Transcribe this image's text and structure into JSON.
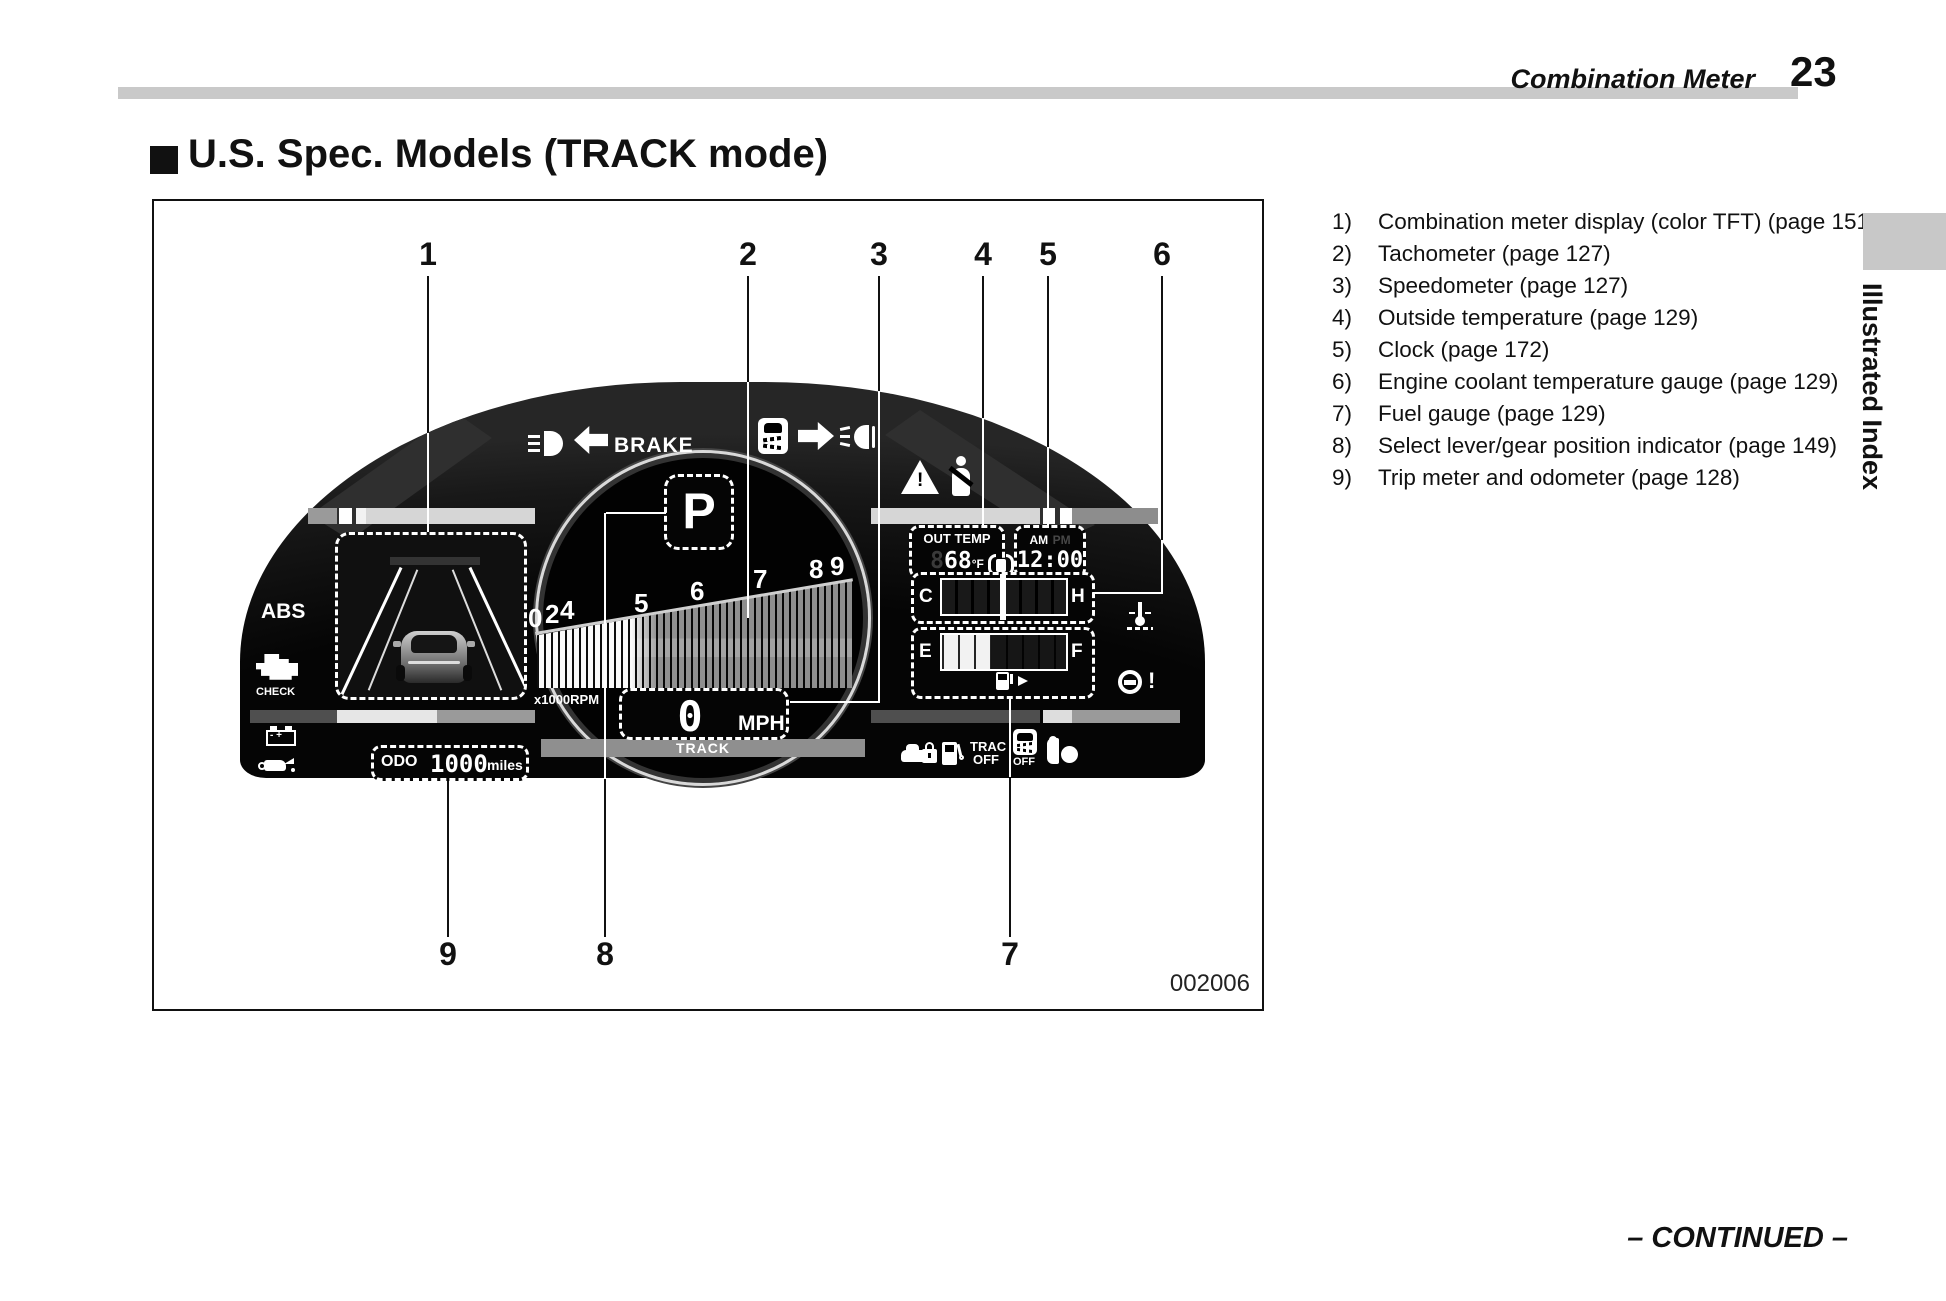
{
  "header": {
    "section": "Combination Meter",
    "page_number": "23"
  },
  "title": {
    "text": "U.S. Spec. Models (TRACK mode)"
  },
  "legend": {
    "items": [
      {
        "num": "1)",
        "text": "Combination meter display (color TFT) (page 151)"
      },
      {
        "num": "2)",
        "text": "Tachometer (page 127)"
      },
      {
        "num": "3)",
        "text": "Speedometer (page 127)"
      },
      {
        "num": "4)",
        "text": "Outside temperature (page 129)"
      },
      {
        "num": "5)",
        "text": "Clock (page 172)"
      },
      {
        "num": "6)",
        "text": "Engine coolant temperature gauge (page 129)"
      },
      {
        "num": "7)",
        "text": "Fuel gauge (page 129)"
      },
      {
        "num": "8)",
        "text": "Select lever/gear position indicator (page 149)"
      },
      {
        "num": "9)",
        "text": "Trip meter and odometer (page 128)"
      }
    ]
  },
  "callouts": {
    "c1": "1",
    "c2": "2",
    "c3": "3",
    "c4": "4",
    "c5": "5",
    "c6": "6",
    "c7": "7",
    "c8": "8",
    "c9": "9"
  },
  "cluster": {
    "brake_label": "BRAKE",
    "abs_label": "ABS",
    "check_label": "CHECK",
    "gear": "P",
    "tach_digits": [
      "0",
      "2",
      "4",
      "5",
      "6",
      "7",
      "8",
      "9"
    ],
    "rpm_multiplier": "x1000RPM",
    "speed_value": "0",
    "speed_unit": "MPH",
    "mode_label": "TRACK",
    "out_temp": {
      "label": "OUT TEMP",
      "ghost": "8",
      "value": "68",
      "unit": "°F"
    },
    "clock": {
      "am": "AM",
      "pm": "PM",
      "time": "12:00"
    },
    "coolant_gauge": {
      "low": "C",
      "high": "H"
    },
    "fuel_gauge": {
      "low": "E",
      "high": "F"
    },
    "trac_off": {
      "line1": "TRAC",
      "line2": "OFF"
    },
    "vsc_off_label": "OFF",
    "odometer": {
      "label": "ODO",
      "value": "1000",
      "unit": "miles"
    }
  },
  "figure_code": "002006",
  "sidebar": {
    "tab_label": "Illustrated Index"
  },
  "footer": {
    "continued": "– CONTINUED –"
  },
  "colors": {
    "accent_gray": "#c9c9c9",
    "cluster_black": "#0a0a0a"
  }
}
